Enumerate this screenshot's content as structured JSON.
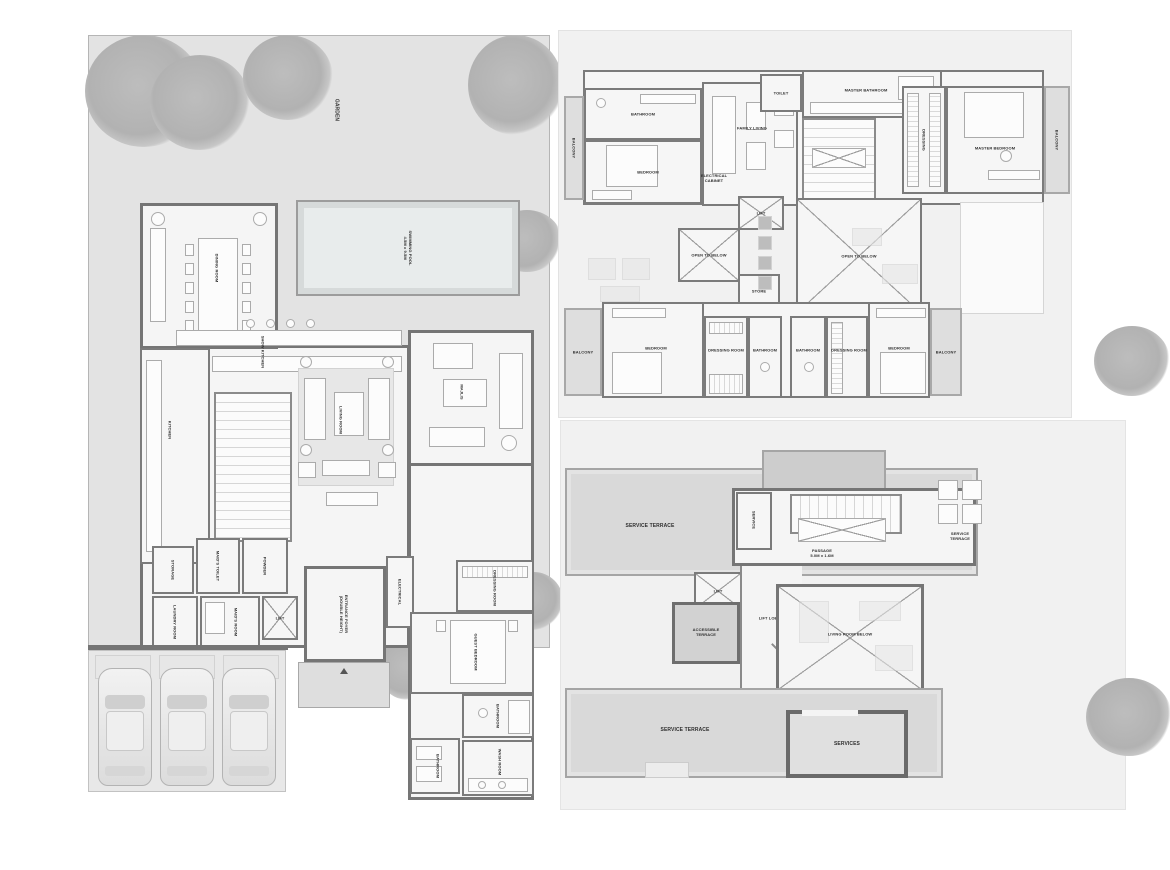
{
  "palette": {
    "wall": "#757575",
    "plot": "#e3e3e3",
    "room": "#f5f5f5",
    "terrace": "#d9d9d9",
    "pool_water": "#e8ecec",
    "tree": "#b5b5b5",
    "label_text": "#2f2f2f"
  },
  "gf": {
    "garden": "GARDEN",
    "pool": "SWIMMING POOL\n4.5M x 9.5M",
    "dining": "DINING ROOM",
    "show_kitchen": "SHOW KITCHEN",
    "kitchen": "KITCHEN",
    "living": "LIVING ROOM",
    "majlis": "MAJLIS",
    "foyer": "ENTRANCE FOYER\n(DOUBLE HEIGHT)",
    "electrical": "ELECTRICAL",
    "storage": "STORAGE",
    "maids_toilet": "MAID'S TOILET",
    "powder": "POWDER",
    "laundry": "LAUNDRY ROOM",
    "maids_room": "MAID'S ROOM",
    "lift": "LIFT",
    "dressing": "DRESSING ROOM",
    "guest_bedroom": "GUEST BEDROOM",
    "bathroom_a": "BATHROOM",
    "bathroom_b": "BATHROOM",
    "wash": "WASH ROOM"
  },
  "ff": {
    "balcony_tl": "BALCONY",
    "bathroom_t": "BATHROOM",
    "bedroom_t": "BEDROOM",
    "family_living": "FAMILY LIVING",
    "electrical_cabinet": "ELECTRICAL\nCABINET",
    "toilet": "TOILET",
    "master_bathroom": "MASTER BATHROOM",
    "dressing": "DRESSING",
    "master_bedroom": "MASTER BEDROOM",
    "balcony_tr": "BALCONY",
    "lift": "LIFT",
    "open_below_small": "OPEN TO BELOW",
    "store": "STORE",
    "open_below_large": "OPEN TO BELOW",
    "balcony_bl": "BALCONY",
    "bedroom_bl": "BEDROOM",
    "dressing_bl": "DRESSING ROOM",
    "bathroom_bl": "BATHROOM",
    "bathroom_br": "BATHROOM",
    "dressing_br": "DRESSING ROOM",
    "bedroom_br": "BEDROOM",
    "balcony_br": "BALCONY"
  },
  "roof": {
    "service_terrace_top": "SERVICE TERRACE",
    "service": "SERVICE",
    "passage": "PASSAGE\n5.0M x 1.6M",
    "service_terrace_right": "SERVICE\nTERRACE",
    "lift": "LIFT",
    "accessible_terrace": "ACCESSIBLE\nTERRACE",
    "lift_lobby": "LIFT LOBBY",
    "living_room_below": "LIVING ROOM BELOW",
    "service_terrace_bottom": "SERVICE TERRACE",
    "services": "SERVICES"
  }
}
